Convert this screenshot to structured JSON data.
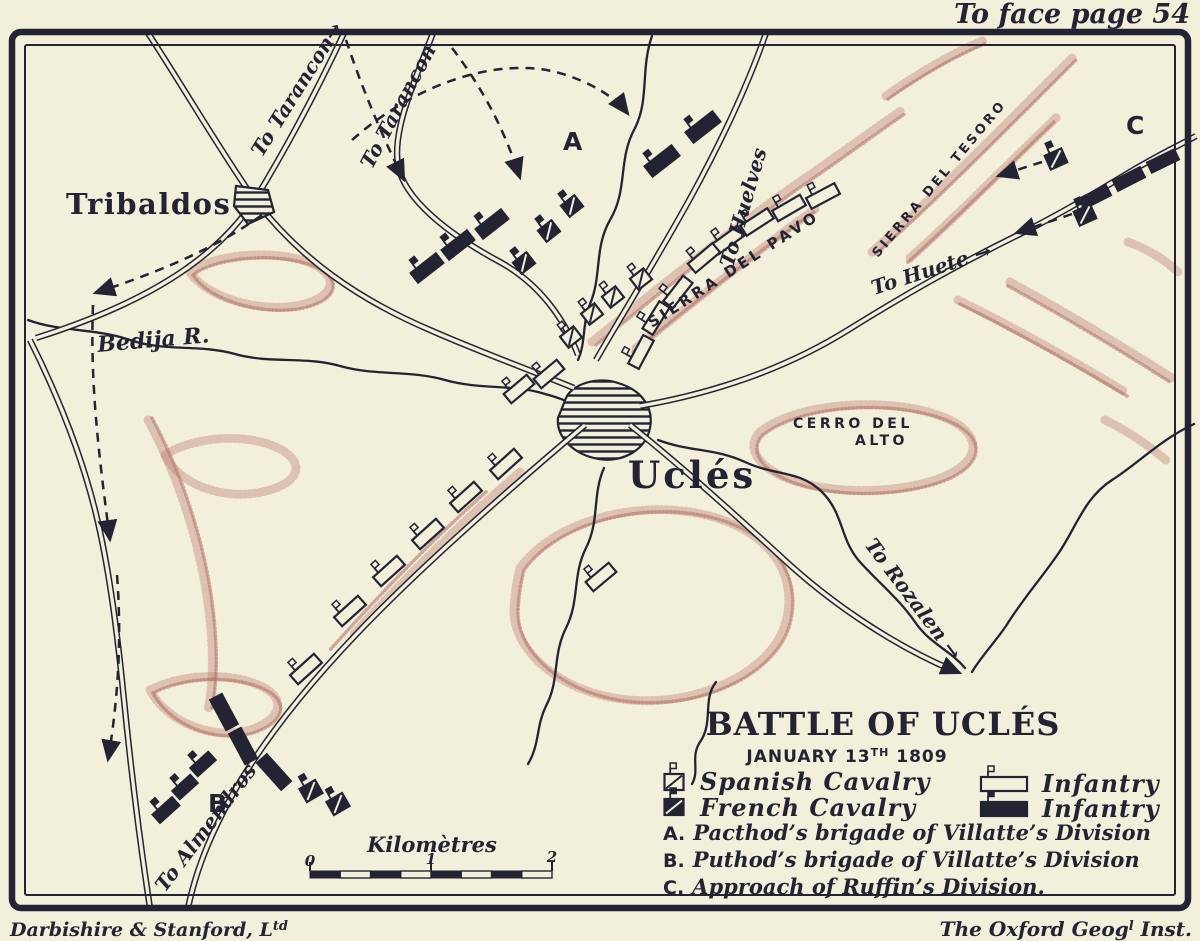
{
  "header": {
    "plate_note": "To face page 54"
  },
  "map": {
    "places": {
      "tribaldos": "Tribaldos",
      "ucles": "Uclés",
      "bedija_river": "Bedija R.",
      "sierra_del_pavo": "SIERRA DEL PAVO",
      "sierra_del_tesoro": "SIERRA DEL TESORO",
      "cerro_del_alto_line1": "CERRO DEL",
      "cerro_del_alto_line2": "ALTO"
    },
    "roads": {
      "to_tarancon_1": "To Tarancon→",
      "to_tarancon_2": "To Tarancon",
      "to_huelves": "To Huelves",
      "to_huete": "To Huete →",
      "to_rozalen": "To Rozalen →",
      "to_almendros": "To Almendros"
    },
    "markers": {
      "a": "A",
      "b": "B",
      "c": "C"
    }
  },
  "title_block": {
    "title": "BATTLE OF UCLÉS",
    "date_line": {
      "prefix": "JANUARY 13",
      "superscript": "TH",
      "suffix": " 1809"
    }
  },
  "legend": {
    "items": [
      {
        "symbol": "spanish-cavalry",
        "label": "Spanish Cavalry"
      },
      {
        "symbol": "french-cavalry",
        "label": "French Cavalry"
      },
      {
        "symbol": "spanish-infantry",
        "label": "Infantry"
      },
      {
        "symbol": "french-infantry",
        "label": "Infantry"
      }
    ],
    "notes": [
      {
        "key": "A.",
        "text": "Pacthod’s brigade of Villatte’s Division"
      },
      {
        "key": "B.",
        "text": "Puthod’s brigade of Villatte’s Division"
      },
      {
        "key": "C.",
        "text": "Approach of Ruffin’s Division."
      }
    ]
  },
  "scale": {
    "label": "Kilomètres",
    "ticks": [
      "0",
      "1",
      "2"
    ]
  },
  "credits": {
    "left": {
      "text": "Darbishire & Stanford, L",
      "superscript": "td"
    },
    "right": {
      "prefix": "The Oxford Geog",
      "superscript": "l",
      "suffix": " Inst."
    }
  },
  "colors": {
    "paper": "#f2efdb",
    "ink": "#232334",
    "terrain": "#bb7a6f"
  },
  "units": [
    {
      "type": "french-infantry",
      "x": 492,
      "y": 224,
      "rot": -38,
      "w": 32,
      "h": 12,
      "flag": true
    },
    {
      "type": "french-infantry",
      "x": 458,
      "y": 245,
      "rot": -38,
      "w": 32,
      "h": 12,
      "flag": true
    },
    {
      "type": "french-infantry",
      "x": 427,
      "y": 268,
      "rot": -38,
      "w": 32,
      "h": 12,
      "flag": true
    },
    {
      "type": "french-infantry",
      "x": 703,
      "y": 127,
      "rot": -38,
      "w": 34,
      "h": 13,
      "flag": true
    },
    {
      "type": "french-infantry",
      "x": 662,
      "y": 161,
      "rot": -38,
      "w": 34,
      "h": 13,
      "flag": true
    },
    {
      "type": "french-infantry",
      "x": 1095,
      "y": 197,
      "rot": -27,
      "w": 30,
      "h": 11,
      "flag": false
    },
    {
      "type": "french-infantry",
      "x": 1129,
      "y": 179,
      "rot": -27,
      "w": 30,
      "h": 11,
      "flag": false
    },
    {
      "type": "french-infantry",
      "x": 1163,
      "y": 161,
      "rot": -26,
      "w": 30,
      "h": 11,
      "flag": false
    },
    {
      "type": "french-infantry",
      "x": 224,
      "y": 712,
      "rot": 62,
      "w": 34,
      "h": 13,
      "flag": false
    },
    {
      "type": "french-infantry",
      "x": 243,
      "y": 746,
      "rot": 62,
      "w": 34,
      "h": 13,
      "flag": false
    },
    {
      "type": "french-infantry",
      "x": 274,
      "y": 772,
      "rot": 48,
      "w": 36,
      "h": 13,
      "flag": false
    },
    {
      "type": "french-infantry",
      "x": 203,
      "y": 764,
      "rot": -42,
      "w": 24,
      "h": 11,
      "flag": true
    },
    {
      "type": "french-infantry",
      "x": 185,
      "y": 787,
      "rot": -42,
      "w": 24,
      "h": 11,
      "flag": true
    },
    {
      "type": "french-infantry",
      "x": 166,
      "y": 810,
      "rot": -42,
      "w": 26,
      "h": 11,
      "flag": true
    },
    {
      "type": "french-cavalry",
      "x": 572,
      "y": 206,
      "rot": -38,
      "w": 17,
      "h": 14,
      "flag": true
    },
    {
      "type": "french-cavalry",
      "x": 549,
      "y": 231,
      "rot": -38,
      "w": 17,
      "h": 14,
      "flag": true
    },
    {
      "type": "french-cavalry",
      "x": 524,
      "y": 263,
      "rot": -38,
      "w": 17,
      "h": 14,
      "flag": true
    },
    {
      "type": "french-cavalry",
      "x": 311,
      "y": 791,
      "rot": -30,
      "w": 18,
      "h": 15,
      "flag": true
    },
    {
      "type": "french-cavalry",
      "x": 338,
      "y": 804,
      "rot": -30,
      "w": 18,
      "h": 15,
      "flag": true
    },
    {
      "type": "french-cavalry",
      "x": 1056,
      "y": 159,
      "rot": -24,
      "w": 18,
      "h": 15,
      "flag": true
    },
    {
      "type": "french-cavalry",
      "x": 1085,
      "y": 215,
      "rot": -24,
      "w": 18,
      "h": 15,
      "flag": true
    },
    {
      "type": "spanish-cavalry",
      "x": 641,
      "y": 279,
      "rot": -38,
      "w": 17,
      "h": 14,
      "flag": true
    },
    {
      "type": "spanish-cavalry",
      "x": 613,
      "y": 297,
      "rot": -38,
      "w": 17,
      "h": 14,
      "flag": true
    },
    {
      "type": "spanish-cavalry",
      "x": 592,
      "y": 314,
      "rot": -38,
      "w": 17,
      "h": 14,
      "flag": true
    },
    {
      "type": "spanish-cavalry",
      "x": 571,
      "y": 337,
      "rot": -38,
      "w": 17,
      "h": 14,
      "flag": true
    },
    {
      "type": "spanish-infantry",
      "x": 823,
      "y": 196,
      "rot": -28,
      "w": 32,
      "h": 12,
      "flag": true
    },
    {
      "type": "spanish-infantry",
      "x": 789,
      "y": 208,
      "rot": -30,
      "w": 32,
      "h": 12,
      "flag": true
    },
    {
      "type": "spanish-infantry",
      "x": 757,
      "y": 222,
      "rot": -33,
      "w": 32,
      "h": 12,
      "flag": true
    },
    {
      "type": "spanish-infantry",
      "x": 728,
      "y": 240,
      "rot": -36,
      "w": 32,
      "h": 12,
      "flag": true
    },
    {
      "type": "spanish-infantry",
      "x": 704,
      "y": 258,
      "rot": -40,
      "w": 32,
      "h": 12,
      "flag": true
    },
    {
      "type": "spanish-infantry",
      "x": 678,
      "y": 292,
      "rot": -52,
      "w": 32,
      "h": 12,
      "flag": true
    },
    {
      "type": "spanish-infantry",
      "x": 656,
      "y": 318,
      "rot": -58,
      "w": 32,
      "h": 12,
      "flag": true
    },
    {
      "type": "spanish-infantry",
      "x": 641,
      "y": 352,
      "rot": -62,
      "w": 32,
      "h": 12,
      "flag": true
    },
    {
      "type": "spanish-infantry",
      "x": 549,
      "y": 374,
      "rot": -40,
      "w": 30,
      "h": 12,
      "flag": true
    },
    {
      "type": "spanish-infantry",
      "x": 519,
      "y": 389,
      "rot": -40,
      "w": 30,
      "h": 12,
      "flag": true
    },
    {
      "type": "spanish-infantry",
      "x": 506,
      "y": 464,
      "rot": -42,
      "w": 32,
      "h": 12,
      "flag": true
    },
    {
      "type": "spanish-infantry",
      "x": 466,
      "y": 497,
      "rot": -42,
      "w": 32,
      "h": 12,
      "flag": true
    },
    {
      "type": "spanish-infantry",
      "x": 428,
      "y": 534,
      "rot": -42,
      "w": 32,
      "h": 12,
      "flag": true
    },
    {
      "type": "spanish-infantry",
      "x": 389,
      "y": 571,
      "rot": -42,
      "w": 32,
      "h": 12,
      "flag": true
    },
    {
      "type": "spanish-infantry",
      "x": 350,
      "y": 611,
      "rot": -42,
      "w": 32,
      "h": 12,
      "flag": true
    },
    {
      "type": "spanish-infantry",
      "x": 306,
      "y": 669,
      "rot": -42,
      "w": 32,
      "h": 12,
      "flag": true
    },
    {
      "type": "spanish-infantry",
      "x": 601,
      "y": 577,
      "rot": -40,
      "w": 30,
      "h": 12,
      "flag": true
    },
    {
      "type": "spanish-cavalry",
      "x": 674,
      "y": 782,
      "rot": 0,
      "w": 19,
      "h": 16,
      "flag": true
    },
    {
      "type": "french-cavalry",
      "x": 674,
      "y": 807,
      "rot": 0,
      "w": 19,
      "h": 16,
      "flag": true
    },
    {
      "type": "spanish-infantry",
      "x": 1004,
      "y": 784,
      "rot": 0,
      "w": 46,
      "h": 14,
      "flag": true
    },
    {
      "type": "french-infantry",
      "x": 1004,
      "y": 809,
      "rot": 0,
      "w": 46,
      "h": 14,
      "flag": true
    }
  ]
}
